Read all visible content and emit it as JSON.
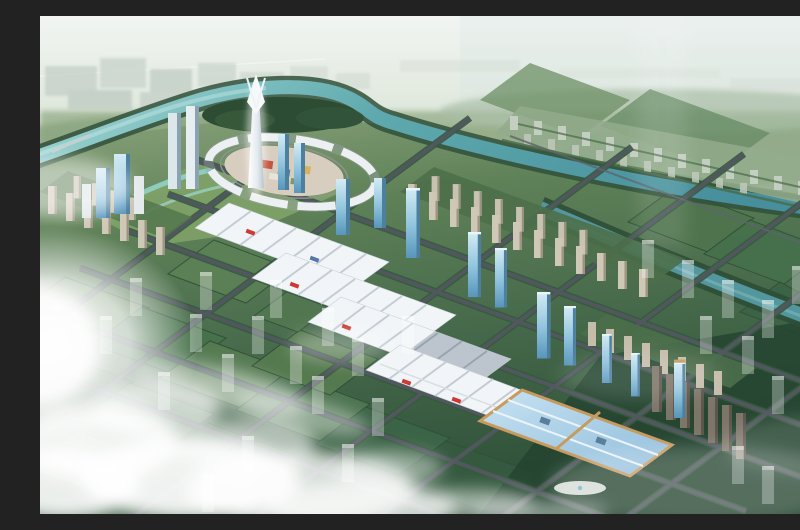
{
  "scene": {
    "type": "aerial-masterplan-rendering",
    "description": "Bird's-eye architectural rendering of a planned riverside city: a winding teal river with an oxbow loop around a circular landmark plaza with a white spire tower and glass skyscrapers, diagonal rows of white exhibition halls stepping toward a blue glass-roofed hall, tan residential rows, square green park blocks in a road grid, translucent future-phase buildings, and white clouds with a bright glow over the lower left."
  },
  "palette": {
    "sky_top": "#f0f4f1",
    "sky_mid": "#dde7dc",
    "haze": "#c6d4c6",
    "distant_green": "#9cb391",
    "water": "#5ea9ae",
    "water_light": "#a4d8d4",
    "water_deep": "#478f9c",
    "field": "#4b6e4d",
    "field_light": "#567a4e",
    "field_mid": "#47714b",
    "field_deep": "#3b6143",
    "field_dark": "#23422f",
    "park_lawn": "#7fa268",
    "island_trees": "#2c4c33",
    "tree_line": "#365a3e",
    "road": "#50585e",
    "road_minor": "#5d656b",
    "hall_roof": "#f1f5f7",
    "hall_stripe": "#c3ccd4",
    "hall_gray": "#b6c0c9",
    "accent_red": "#cd3a33",
    "accent_blue": "#5577aa",
    "glass_hi": "#d4ecf5",
    "glass_lo": "#7fb4d4",
    "glass_deep": "#4d7f9e",
    "blue_roof": "#a9cfe6",
    "roof_tan": "#c79a5e",
    "res_tan": "#cfc8b6",
    "res_tan_dk": "#9d9582",
    "res_dark": "#7d7568",
    "res_dark_dk": "#5c564c",
    "spire": "#f4f7f8",
    "plaza": "#d8cec0",
    "cloud": "#ffffff",
    "distant_city": "#c9d3cb",
    "town_pale": "#c8d2c6"
  },
  "landmarks": [
    {
      "name": "central-spire-tower"
    },
    {
      "name": "circular-landmark-plaza"
    },
    {
      "name": "river-oxbow-loop"
    },
    {
      "name": "exhibition-hall-rows"
    },
    {
      "name": "blue-glass-roof-hall"
    },
    {
      "name": "glass-tower-line"
    },
    {
      "name": "residential-rows"
    },
    {
      "name": "green-park-grid"
    },
    {
      "name": "cloud-layer"
    }
  ]
}
